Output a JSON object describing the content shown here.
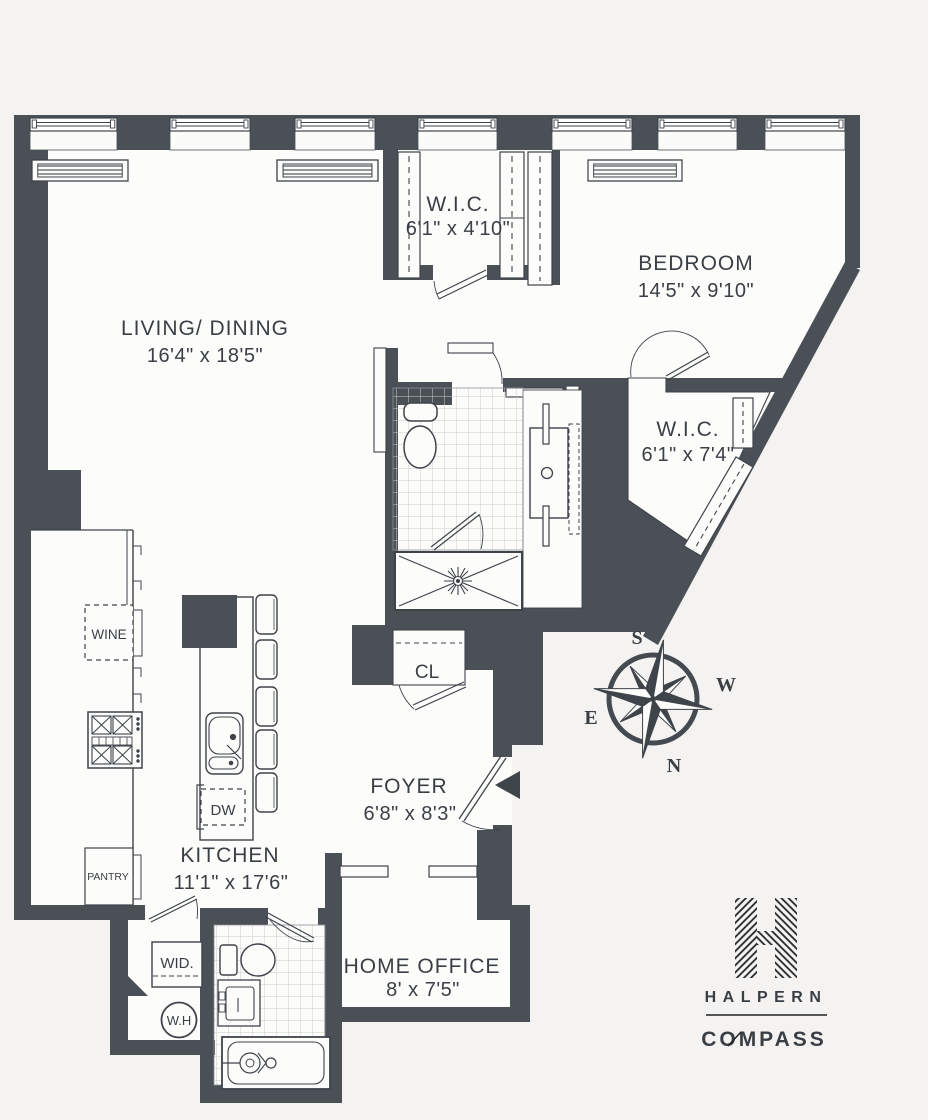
{
  "meta": {
    "background_color": "#f4f3f1",
    "wall_color": "#4b5057",
    "line_color": "#3e434a",
    "logo_color": "#202326"
  },
  "rooms": {
    "living": {
      "name": "LIVING/ DINING",
      "dims": "16'4\" x 18'5\""
    },
    "wic1": {
      "name": "W.I.C.",
      "dims": "6'1\" x 4'10\""
    },
    "bedroom": {
      "name": "BEDROOM",
      "dims": "14'5\" x 9'10\""
    },
    "wic2": {
      "name": "W.I.C.",
      "dims": "6'1\" x 7'4\""
    },
    "foyer": {
      "name": "FOYER",
      "dims": "6'8\" x 8'3\""
    },
    "kitchen": {
      "name": "KITCHEN",
      "dims": "11'1\" x 17'6\""
    },
    "home_office": {
      "name": "HOME OFFICE",
      "dims": "8' x 7'5\""
    }
  },
  "fixtures": {
    "closet": "CL",
    "wine_fridge": "WINE",
    "pantry": "PANTRY",
    "washer_dryer": "WID.",
    "water_heater": "W.H",
    "dishwasher": "DW"
  },
  "compass": {
    "north": "N",
    "south": "S",
    "east": "E",
    "west": "W"
  },
  "branding": {
    "team": "HALPERN",
    "brokerage": "COMPASS"
  }
}
